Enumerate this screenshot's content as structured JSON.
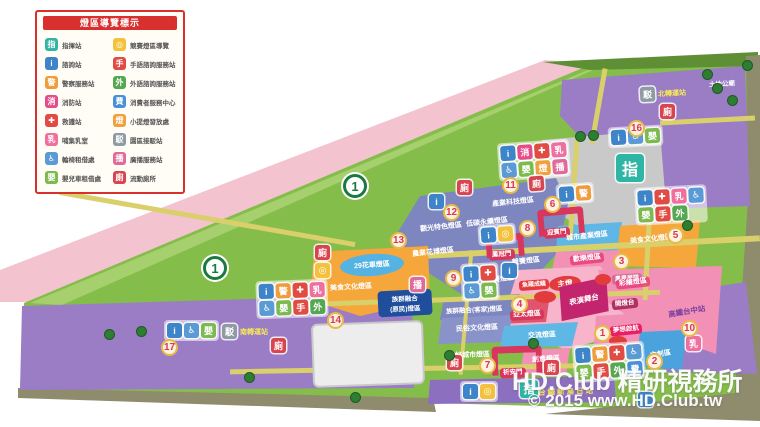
{
  "legend": {
    "title": "燈區導覽標示",
    "left": [
      {
        "label": "指揮站",
        "icon": "command"
      },
      {
        "label": "諮詢站",
        "icon": "info"
      },
      {
        "label": "警察服務站",
        "icon": "police"
      },
      {
        "label": "消防站",
        "icon": "fire"
      },
      {
        "label": "救護站",
        "icon": "aid"
      },
      {
        "label": "哺集乳室",
        "icon": "nursing"
      },
      {
        "label": "輪椅租借處",
        "icon": "wheelchair"
      },
      {
        "label": "嬰兒車租借處",
        "icon": "stroller"
      }
    ],
    "right": [
      {
        "label": "競賽燈區導覽",
        "icon": "contest"
      },
      {
        "label": "手語諮詢服務站",
        "icon": "signlang"
      },
      {
        "label": "外語諮詢服務站",
        "icon": "foreign"
      },
      {
        "label": "消費者服務中心",
        "icon": "consumer"
      },
      {
        "label": "小提燈發放處",
        "icon": "lantern"
      },
      {
        "label": "園區接駁站",
        "icon": "shuttle"
      },
      {
        "label": "廣播服務站",
        "icon": "broadcast"
      },
      {
        "label": "流動廁所",
        "icon": "toilet"
      }
    ]
  },
  "icons": {
    "command": {
      "glyph": "指",
      "color": "#2fb5a3"
    },
    "info": {
      "glyph": "i",
      "color": "#3d85c8"
    },
    "police": {
      "glyph": "警",
      "color": "#f09c3c"
    },
    "fire": {
      "glyph": "消",
      "color": "#e44d8a"
    },
    "aid": {
      "glyph": "✚",
      "color": "#e04b44"
    },
    "nursing": {
      "glyph": "乳",
      "color": "#ef6f9f"
    },
    "wheelchair": {
      "glyph": "♿",
      "color": "#5b9bd5"
    },
    "stroller": {
      "glyph": "嬰",
      "color": "#7cb94e"
    },
    "contest": {
      "glyph": "◎",
      "color": "#f2c23e"
    },
    "signlang": {
      "glyph": "手",
      "color": "#e04b44"
    },
    "foreign": {
      "glyph": "外",
      "color": "#55a84f"
    },
    "consumer": {
      "glyph": "費",
      "color": "#4a90d9"
    },
    "lantern": {
      "glyph": "燈",
      "color": "#f0a03c"
    },
    "shuttle": {
      "glyph": "駁",
      "color": "#8f9aa3"
    },
    "broadcast": {
      "glyph": "播",
      "color": "#e06a9a"
    },
    "toilet": {
      "glyph": "廁",
      "color": "#d8454f"
    }
  },
  "map": {
    "highway": "1",
    "points": [
      "1",
      "2",
      "3",
      "4",
      "5",
      "6",
      "7",
      "8",
      "9",
      "10",
      "11",
      "12",
      "13",
      "14",
      "16",
      "17"
    ],
    "zones": [
      {
        "name": "產業科技燈區"
      },
      {
        "name": "低碳永續燈區"
      },
      {
        "name": "觀光特色燈區"
      },
      {
        "name": "農業花博燈區"
      },
      {
        "name": "競賽燈區"
      },
      {
        "name": "競賽燈區"
      },
      {
        "name": "城市產業燈區"
      },
      {
        "name": "歡樂燈區"
      },
      {
        "name": "美食文化燈區"
      },
      {
        "name": "彩繪燈區"
      },
      {
        "name": "29花車燈區"
      },
      {
        "name": "美食文化燈區"
      },
      {
        "name": "族群融合(客家)燈區"
      },
      {
        "name": "民俗文化燈區"
      },
      {
        "name": "亞太燈區"
      },
      {
        "name": "交流燈區"
      },
      {
        "name": "友好城市燈區"
      },
      {
        "name": "創意燈區"
      },
      {
        "name": "文創區"
      },
      {
        "line1": "族群融合",
        "line2": "(原民)燈區"
      }
    ],
    "gates": [
      {
        "name": "迎賓門"
      },
      {
        "name": "鳳冠門"
      },
      {
        "name": "祈安門"
      }
    ],
    "stations": [
      {
        "name": "北轉運站"
      },
      {
        "name": "南轉運站"
      },
      {
        "name": "台鐵新烏日站"
      },
      {
        "name": "高鐵台中站"
      },
      {
        "name": "土地公廟"
      }
    ],
    "landmarks": {
      "main_lantern": "主燈",
      "stage": "表演舞台",
      "lighting_stage": "開燈台",
      "dream": "夢想啟航",
      "fish": "魚躍成龍",
      "phoenix": "鳳凰展翅",
      "hq": "指"
    }
  },
  "watermark": {
    "line1": "HD.Club 精研視務所",
    "line2": "© 2015  www.HD.Club.tw"
  }
}
